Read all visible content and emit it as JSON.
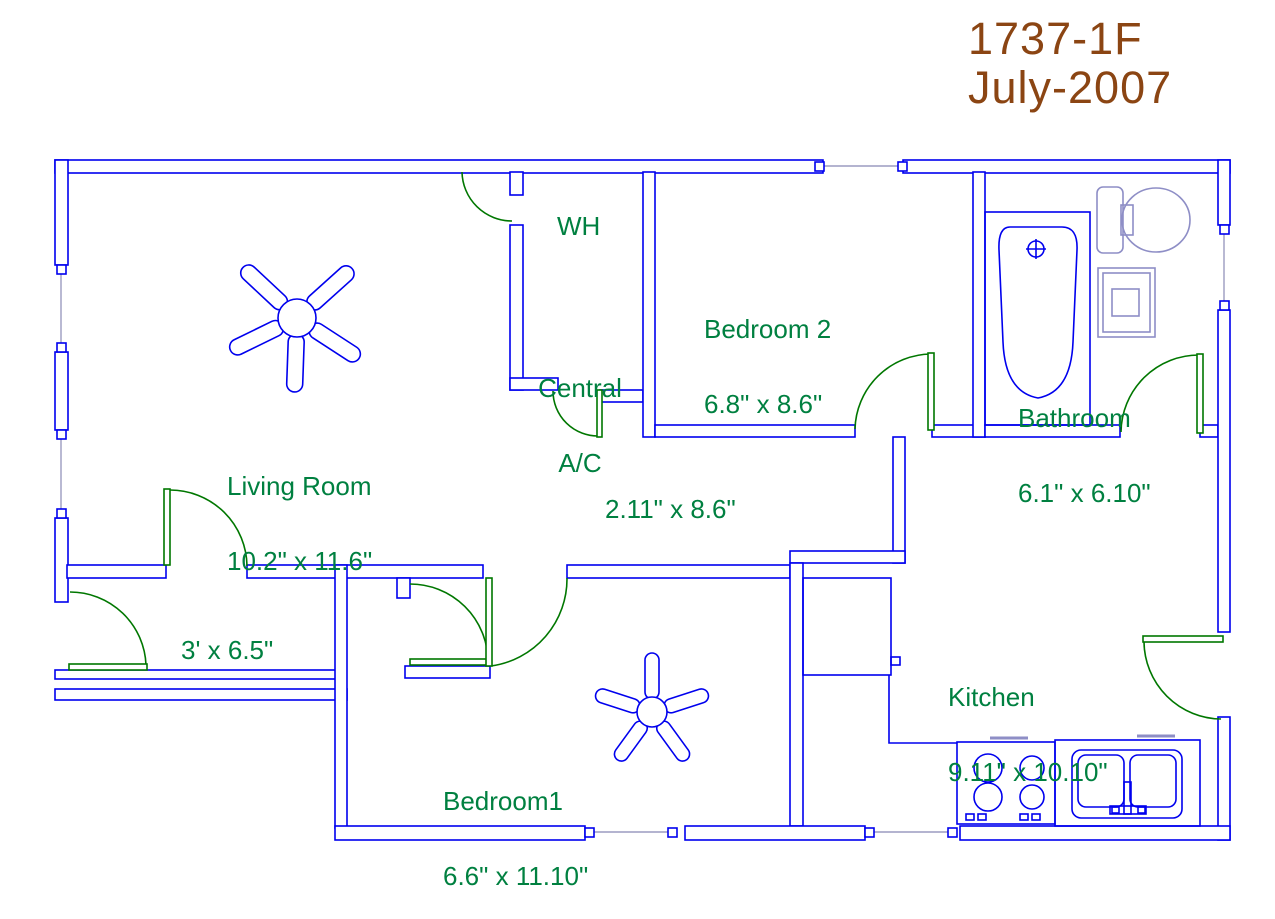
{
  "title": {
    "model": "1737-1F",
    "date": "July-2007",
    "color": "#8B4513"
  },
  "colors": {
    "wall_blue": "#0000ee",
    "door_green": "#007700",
    "label_green": "#008040",
    "fixture_slate": "#8e8ec6",
    "window_gray": "#9b9bc0",
    "background": "#ffffff"
  },
  "labels": {
    "wh": {
      "text": "WH"
    },
    "central_ac": {
      "line1": "Central",
      "line2": "A/C"
    },
    "bedroom2": {
      "name": "Bedroom 2",
      "dims": "6.8\" x 8.6\""
    },
    "bathroom": {
      "name": "Bathroom",
      "dims": "6.1\" x 6.10\""
    },
    "living_room": {
      "name": "Living Room",
      "dims": "10.2\" x 11.6\""
    },
    "corridor": {
      "dims": "2.11\" x 8.6\""
    },
    "entry_hall": {
      "dims": "3' x 6.5\""
    },
    "bedroom1": {
      "name": "Bedroom1",
      "dims": "6.6\" x 11.10\""
    },
    "kitchen": {
      "name": "Kitchen",
      "dims": "9.11\" x 10.10\""
    }
  },
  "fixtures": [
    "ceiling-fan",
    "ceiling-fan",
    "bathtub",
    "toilet",
    "vanity-sink",
    "refrigerator",
    "stove",
    "kitchen-double-sink"
  ]
}
